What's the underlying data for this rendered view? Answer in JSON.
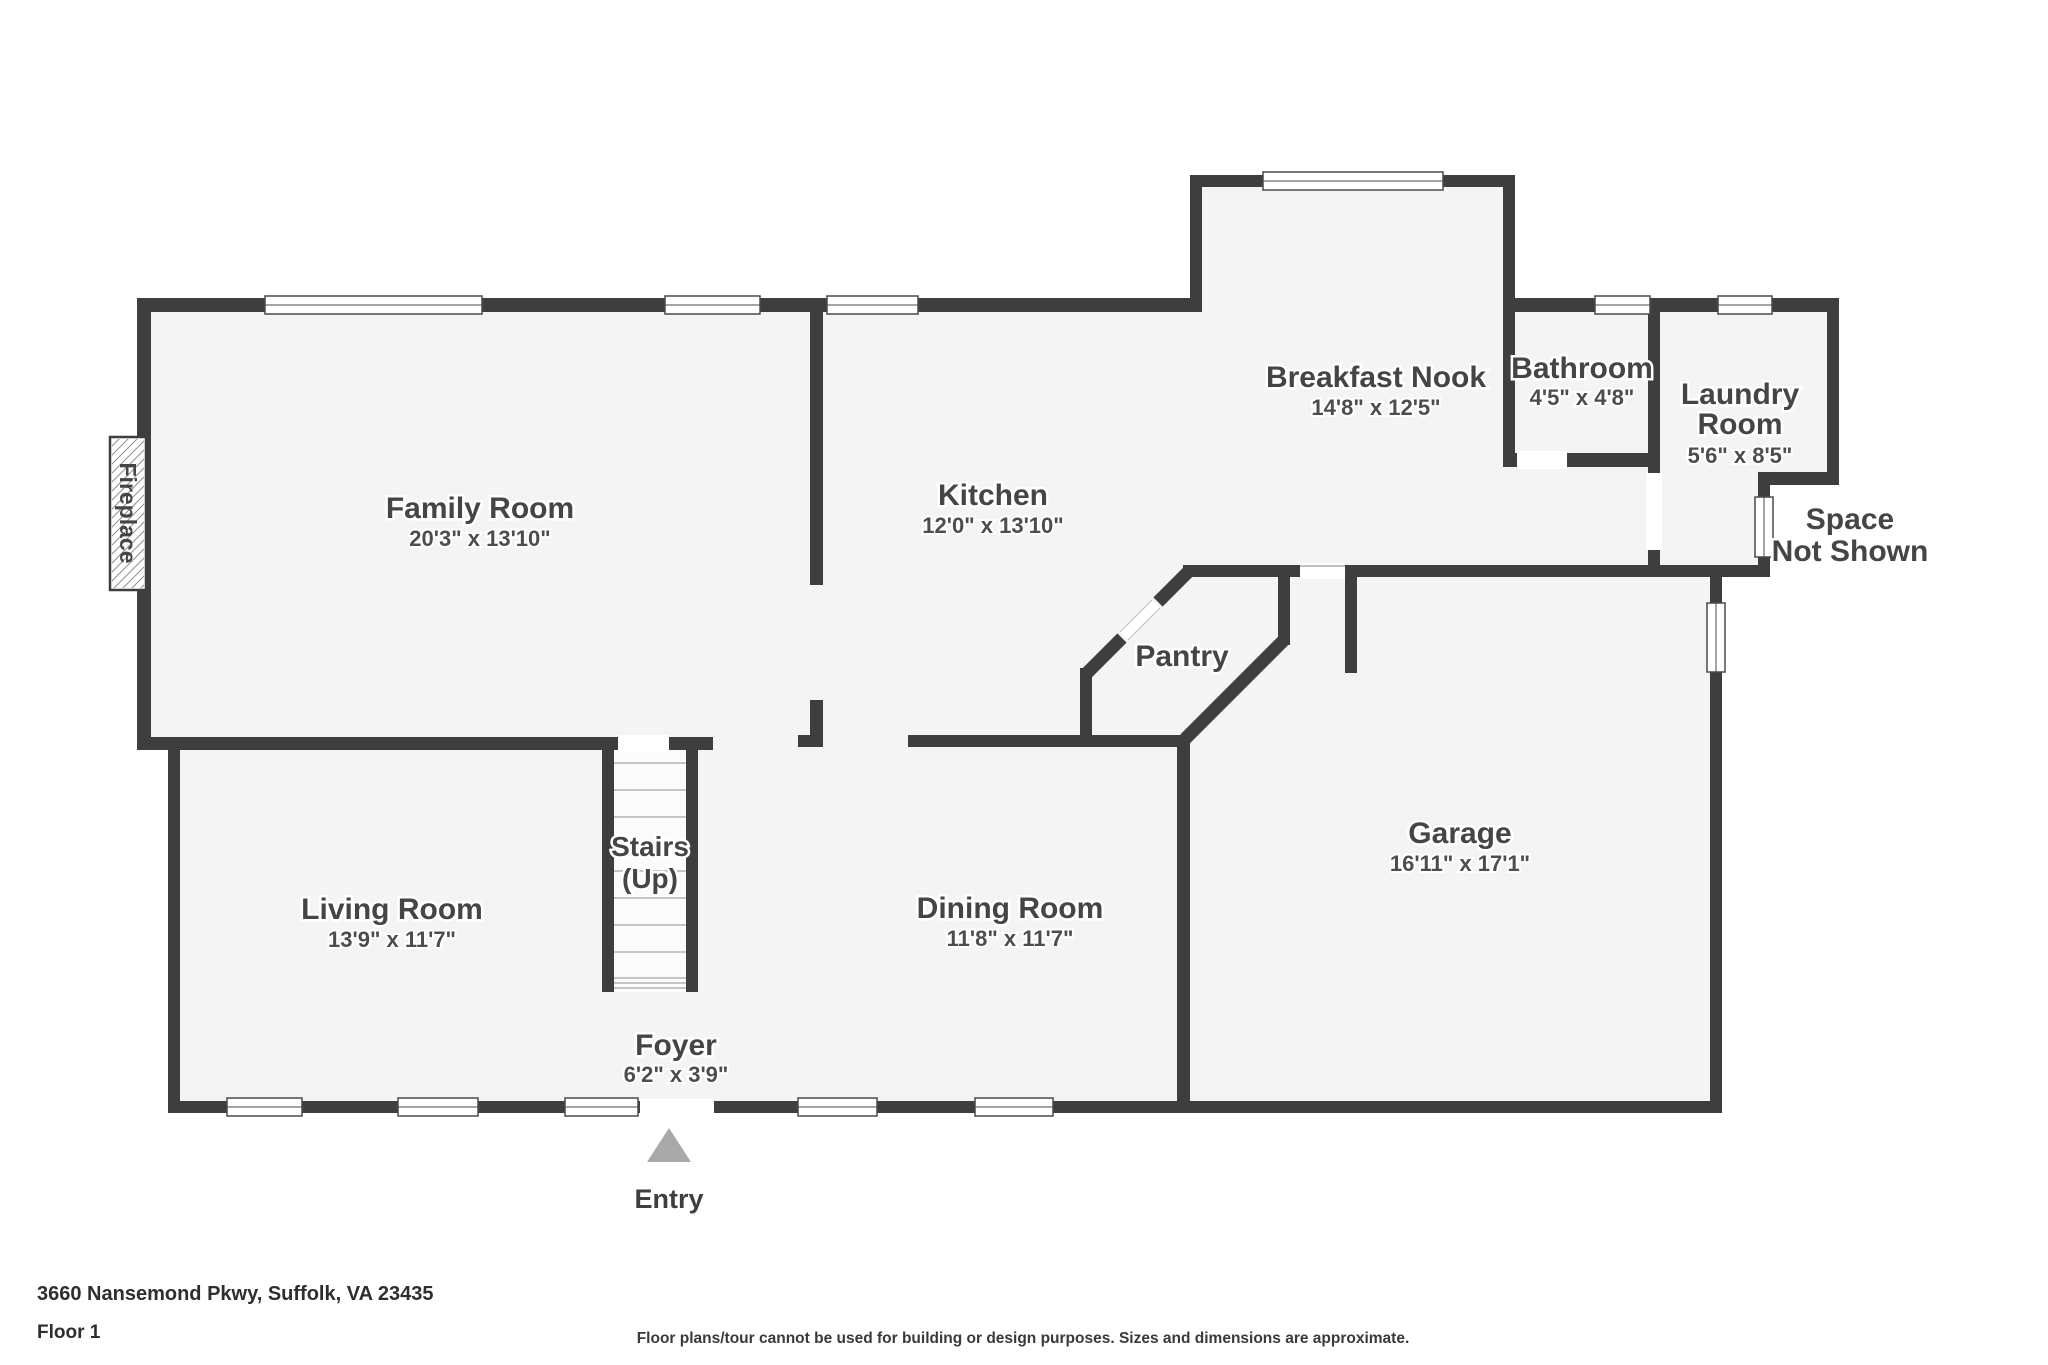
{
  "palette": {
    "wall": "#3e3e3e",
    "floor": "#f4f4f4",
    "stair_floor": "#fbfbfb",
    "window_fill": "#ffffff",
    "window_line": "#4a4a4a",
    "tread_line": "#b5b5b5",
    "entry_arrow": "#a9a9a9",
    "label_text": "#454545"
  },
  "rooms": [
    {
      "id": "family-room",
      "name": "Family Room",
      "dims": "20'3\" x 13'10\""
    },
    {
      "id": "kitchen",
      "name": "Kitchen",
      "dims": "12'0\" x 13'10\""
    },
    {
      "id": "breakfast-nook",
      "name": "Breakfast Nook",
      "dims": "14'8\" x 12'5\""
    },
    {
      "id": "bathroom",
      "name": "Bathroom",
      "dims": "4'5\" x 4'8\""
    },
    {
      "id": "laundry-room",
      "lines": [
        "Laundry",
        "Room"
      ],
      "dims": "5'6\" x 8'5\""
    },
    {
      "id": "garage",
      "name": "Garage",
      "dims": "16'11\" x 17'1\""
    },
    {
      "id": "dining-room",
      "name": "Dining Room",
      "dims": "11'8\" x 11'7\""
    },
    {
      "id": "living-room",
      "name": "Living Room",
      "dims": "13'9\" x 11'7\""
    },
    {
      "id": "foyer",
      "name": "Foyer",
      "dims": "6'2\" x 3'9\""
    }
  ],
  "annotations": {
    "pantry": "Pantry",
    "stairs_line1": "Stairs",
    "stairs_line2": "(Up)",
    "entry": "Entry",
    "fireplace": "Fireplace",
    "space_line1": "Space",
    "space_line2": "Not Shown"
  },
  "footer": {
    "address": "3660 Nansemond Pkwy, Suffolk, VA 23435",
    "floor": "Floor 1",
    "disclaimer": "Floor plans/tour cannot be used for building or design purposes. Sizes and dimensions are approximate."
  }
}
